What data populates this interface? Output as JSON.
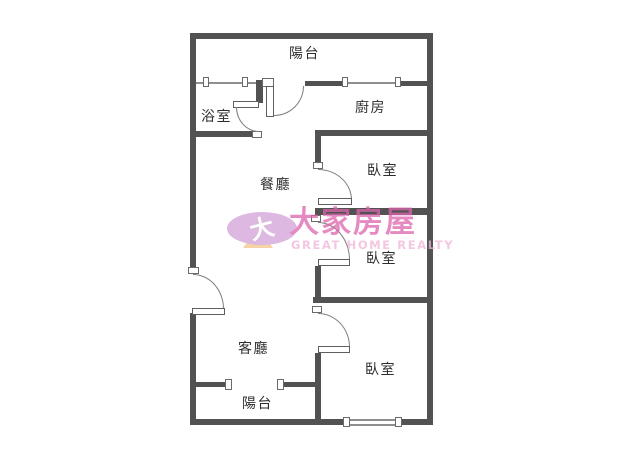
{
  "plan": {
    "rooms": {
      "balcony_top": "陽台",
      "bathroom": "浴室",
      "kitchen": "廚房",
      "dining": "餐廳",
      "bedroom_top": "臥室",
      "bedroom_middle": "臥室",
      "bedroom_bottom": "臥室",
      "living": "客廳",
      "balcony_bottom": "陽台"
    },
    "colors": {
      "wall": "#525252",
      "window": "#8f8f8f",
      "label": "#2e2e2e"
    }
  },
  "watermark": {
    "logo_character": "大",
    "brand_name": "大家房屋",
    "tagline": "GREAT HOME REALTY",
    "colors": {
      "logo_ellipse": "#d2a0d6",
      "logo_triangle": "#f2c488",
      "brand_text": "#de64ae",
      "tagline_text": "#efb3d8"
    }
  }
}
